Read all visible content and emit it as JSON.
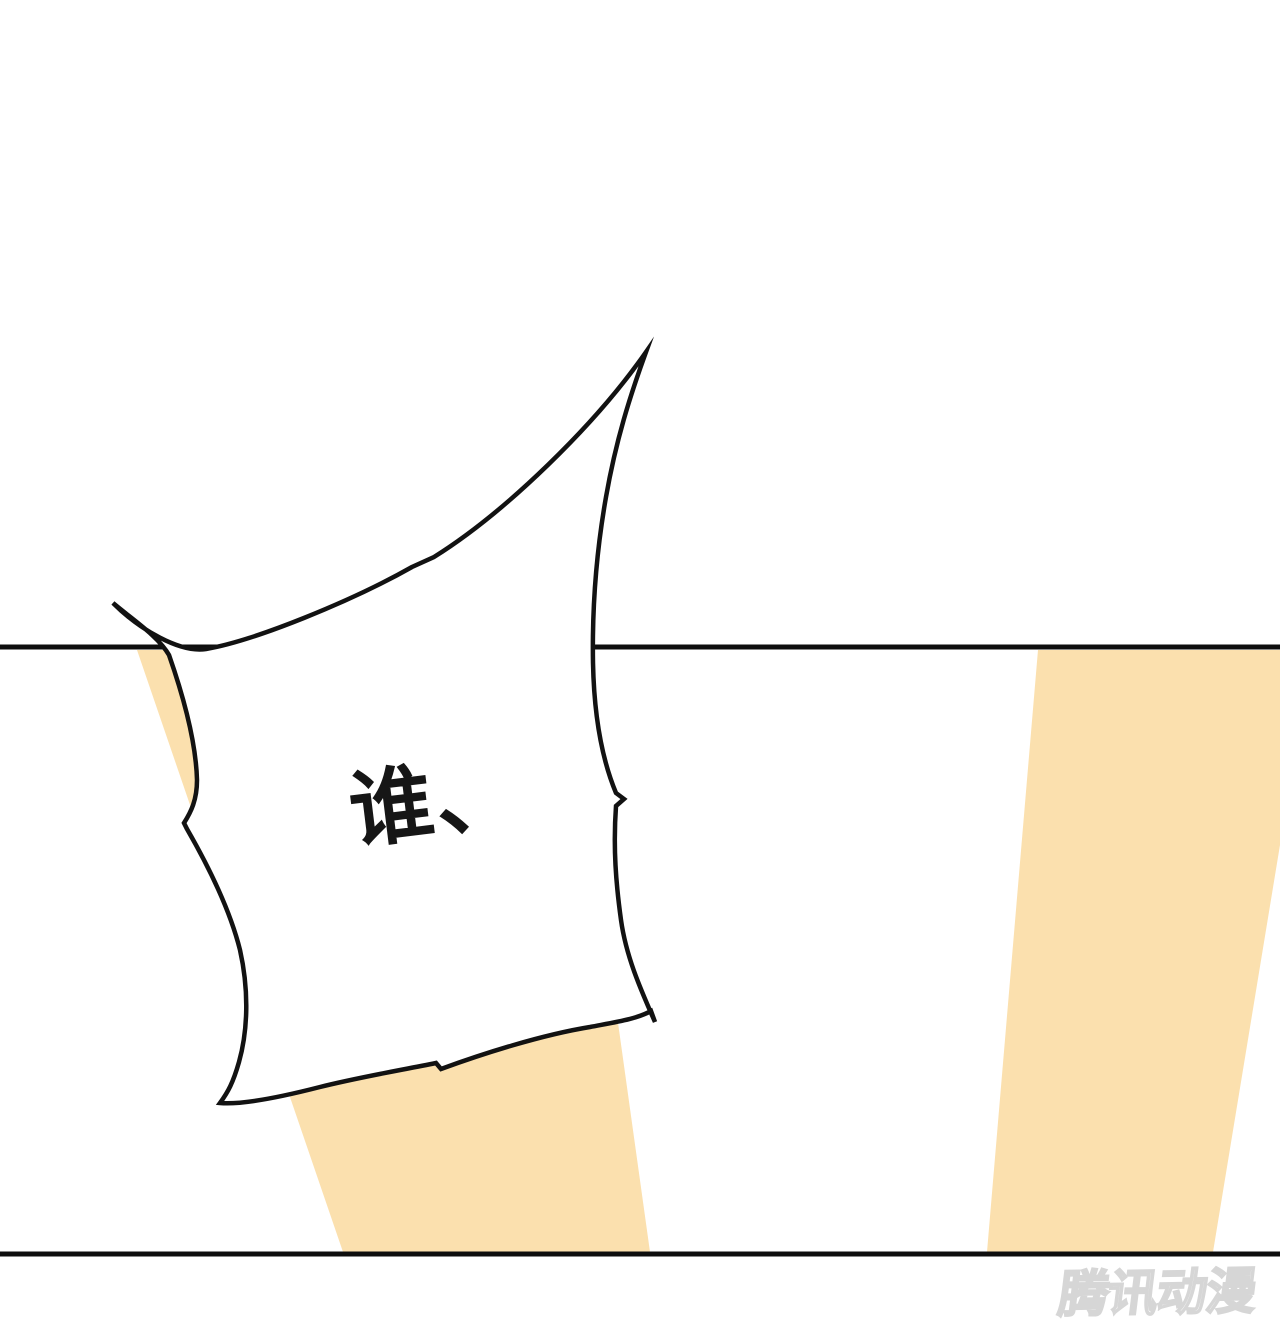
{
  "canvas": {
    "width_px": 1280,
    "height_px": 1344,
    "background_color": "#ffffff"
  },
  "panel": {
    "top_border_y": 647,
    "bottom_border_y": 1254,
    "border_color": "#0e0e0e",
    "ray_color": "#fbe0ae",
    "ray_count": 2
  },
  "speech_bubble": {
    "text": "谁、",
    "text_color": "#161616",
    "fill_color": "#ffffff",
    "outline_color": "#121212",
    "rotation_deg": -7,
    "font_px": 84
  },
  "watermark": {
    "text": "腾讯动漫",
    "fill_color": "#ffffff",
    "outline_color": "#d6d6d6"
  }
}
